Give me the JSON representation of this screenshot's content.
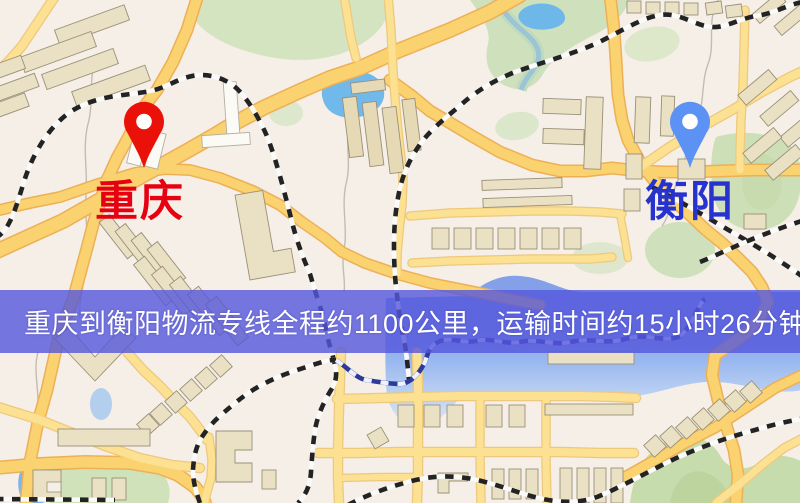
{
  "banner": {
    "text": "重庆到衡阳物流专线全程约1100公里，运输时间约15小时26分钟.",
    "bg_color": "rgba(84,86,220,0.80)",
    "text_color": "#ffffff"
  },
  "origin": {
    "label": "重庆",
    "label_color": "#e60011",
    "pin_color": "#ea1208"
  },
  "destination": {
    "label": "衡阳",
    "label_color": "#2633cf",
    "pin_color": "#5b92f4"
  },
  "map_palette": {
    "background": "#f5efe8",
    "road_major": "#f9d271",
    "road_minor": "#fbe195",
    "road_border": "#ecb058",
    "building": "#eae0c4",
    "building_outline": "#9a9078",
    "park_green": "#d4e4c1",
    "water_blue": "#72b8ea",
    "railway_dark": "#232323",
    "railway_navy": "#2c3a96"
  }
}
